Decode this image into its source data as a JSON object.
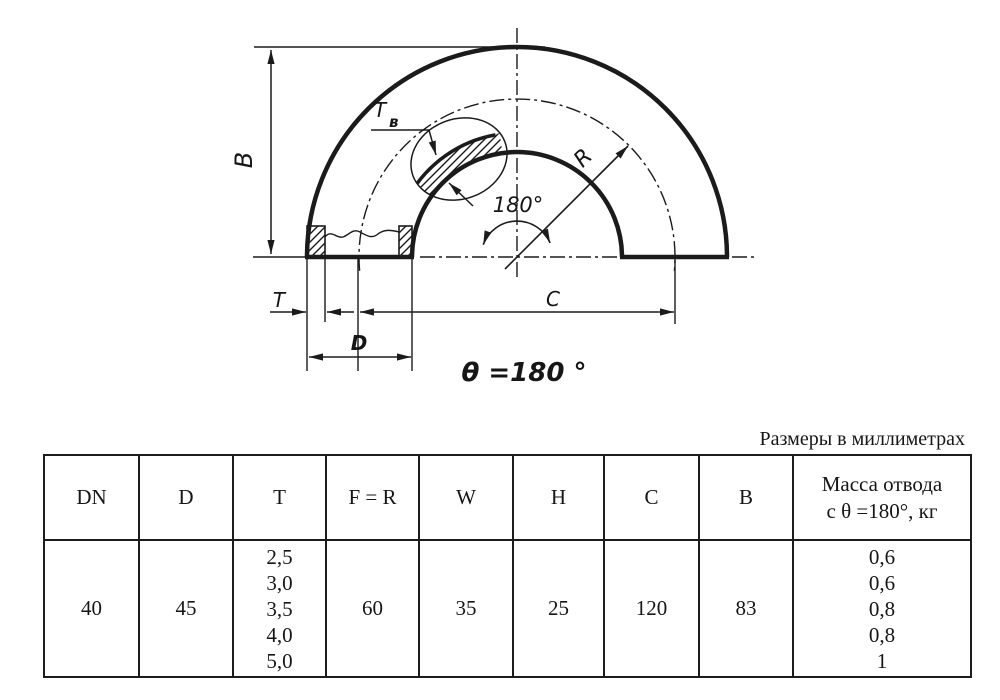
{
  "page": {
    "background": "#ffffff",
    "line_color": "#1b1b1b"
  },
  "drawing": {
    "dim_labels": {
      "b": "B",
      "t": "T",
      "d": "D",
      "c": "C",
      "r": "R",
      "tv_main": "T",
      "tv_sub": "в"
    },
    "angle_label": "180°",
    "theta_label": "θ =180 °"
  },
  "note": "Размеры в миллиметрах",
  "table": {
    "headers": [
      "DN",
      "D",
      "T",
      "F = R",
      "W",
      "H",
      "C",
      "B"
    ],
    "mass_header_line1": "Масса отвода",
    "mass_header_line2": "с θ =180°, кг",
    "row": {
      "dn": "40",
      "d": "45",
      "t_values": [
        "2,5",
        "3,0",
        "3,5",
        "4,0",
        "5,0"
      ],
      "f_r": "60",
      "w": "35",
      "h": "25",
      "c": "120",
      "b": "83",
      "mass_values": [
        "0,6",
        "0,6",
        "0,8",
        "0,8",
        "1"
      ]
    }
  }
}
